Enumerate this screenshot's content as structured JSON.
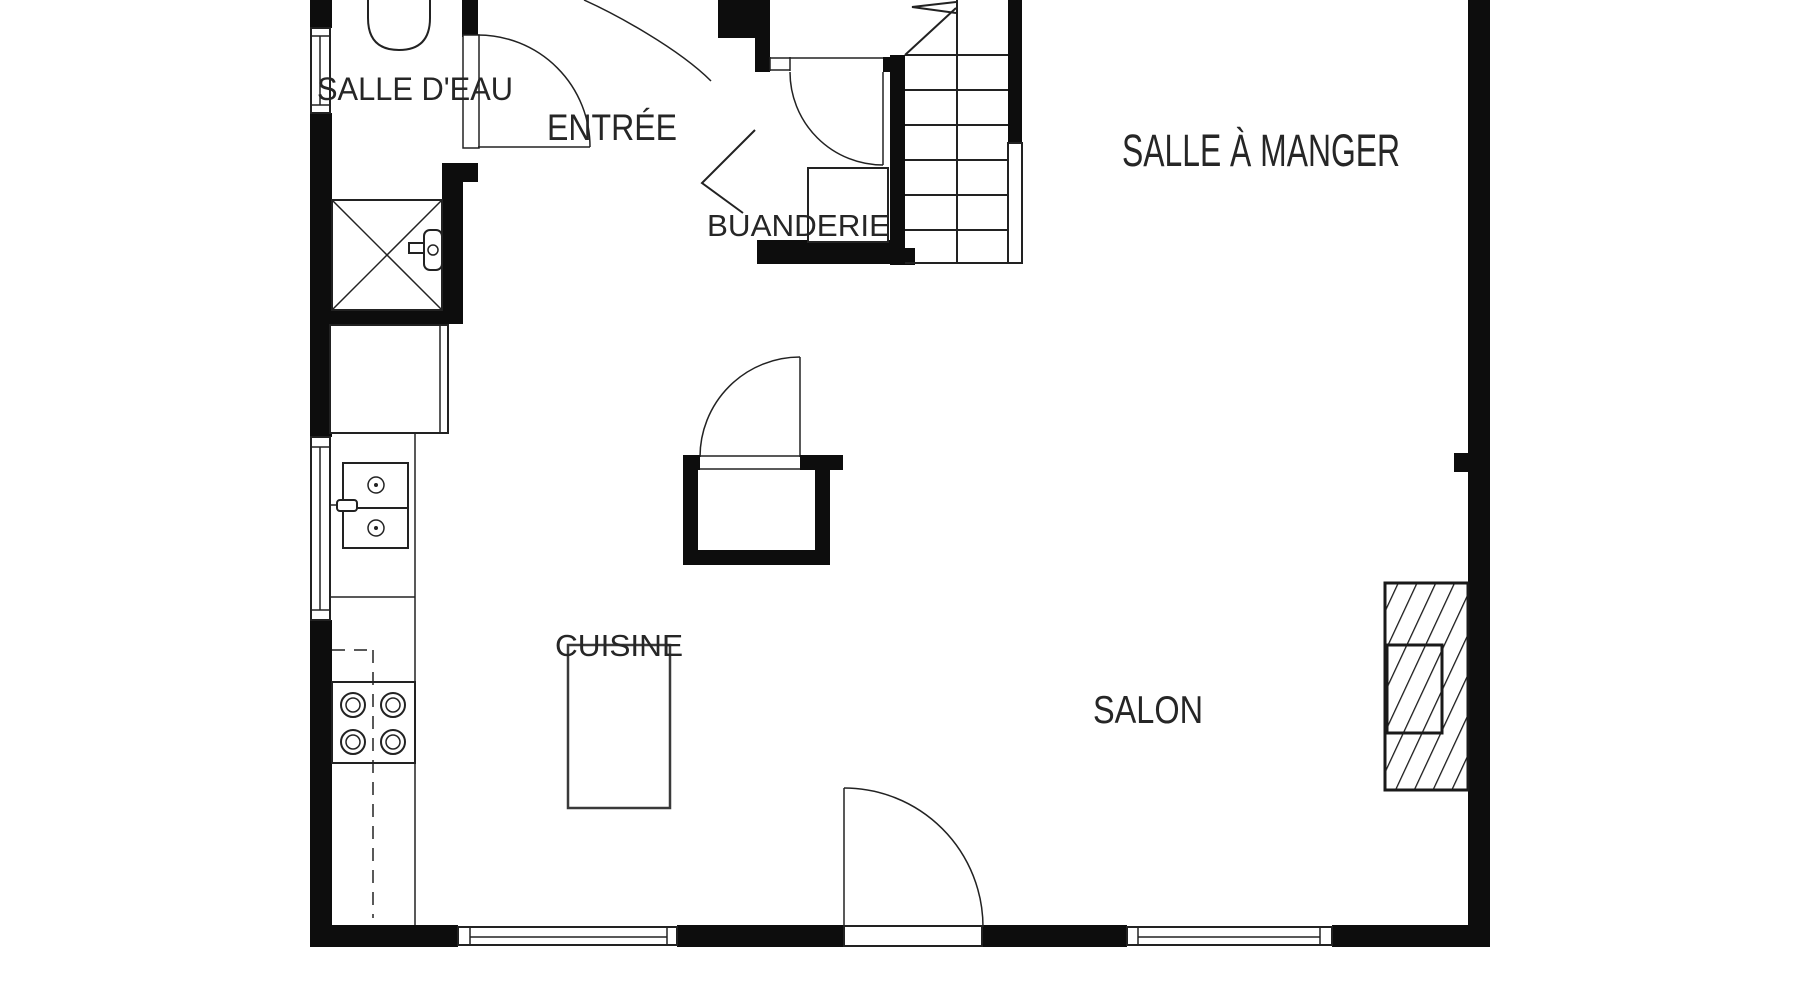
{
  "plan": {
    "type": "floor-plan",
    "rooms": [
      {
        "id": "salle-deau",
        "label": "SALLE D'EAU"
      },
      {
        "id": "entree",
        "label": "ENTRÉE"
      },
      {
        "id": "buanderie",
        "label": "BUANDERIE"
      },
      {
        "id": "salle-a-manger",
        "label": "SALLE À MANGER"
      },
      {
        "id": "cuisine",
        "label": "CUISINE"
      },
      {
        "id": "salon",
        "label": "SALON"
      }
    ],
    "features": [
      "stairs-with-up-arrow",
      "toilet",
      "shower",
      "sink",
      "stove",
      "refrigerator-cabinet",
      "kitchen-counter",
      "kitchen-table",
      "storage-island",
      "fireplace",
      "windows",
      "doors"
    ]
  },
  "colors": {
    "wall": "#0d0d0d",
    "line": "#222222",
    "text": "#262626",
    "background": "#ffffff"
  }
}
